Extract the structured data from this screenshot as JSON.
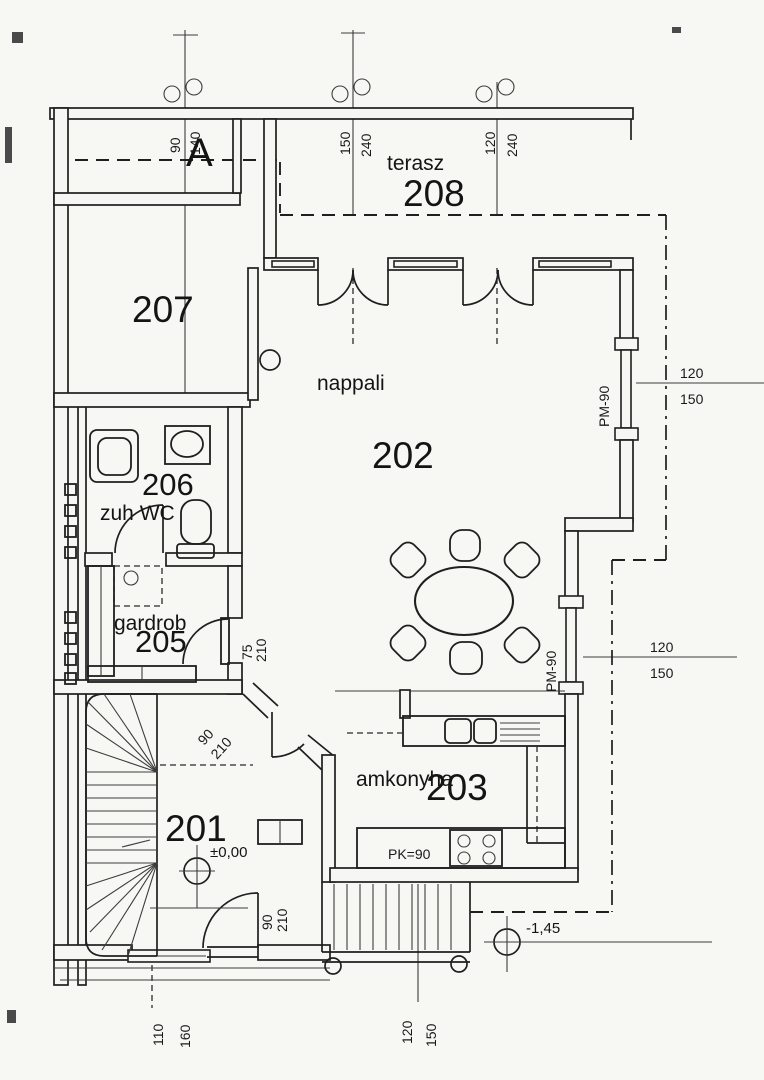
{
  "plan": {
    "section_label": "A",
    "rooms": {
      "hall": {
        "number": "201"
      },
      "living": {
        "name": "nappali",
        "number": "202"
      },
      "kitchen": {
        "name": "amkonyha",
        "number": "203"
      },
      "wardrobe": {
        "name": "gardrob",
        "number": "205"
      },
      "bath": {
        "name": "zuh WC",
        "number": "206"
      },
      "neighbor": {
        "number": "207"
      },
      "terrace": {
        "name": "terasz",
        "number": "208"
      }
    },
    "levels": {
      "ground": "±0,00",
      "entry": "-1,45"
    },
    "dims": {
      "win_top_1": {
        "w": "90",
        "h": "140"
      },
      "win_top_2": {
        "w": "150",
        "h": "240"
      },
      "win_top_3": {
        "w": "120",
        "h": "240"
      },
      "win_right_1": {
        "w": "120",
        "h": "150",
        "parapet": "PM-90"
      },
      "win_right_2": {
        "w": "120",
        "h": "150",
        "parapet": "PM-90"
      },
      "door_wardrobe": {
        "w": "75",
        "h": "210"
      },
      "door_hall": {
        "w": "90",
        "h": "210"
      },
      "door_entry": {
        "w": "90",
        "h": "210"
      },
      "win_bottom_left": {
        "w": "110",
        "h": "160"
      },
      "win_bottom_right": {
        "w": "120",
        "h": "150"
      },
      "kitchen_counter": "PK=90"
    }
  }
}
